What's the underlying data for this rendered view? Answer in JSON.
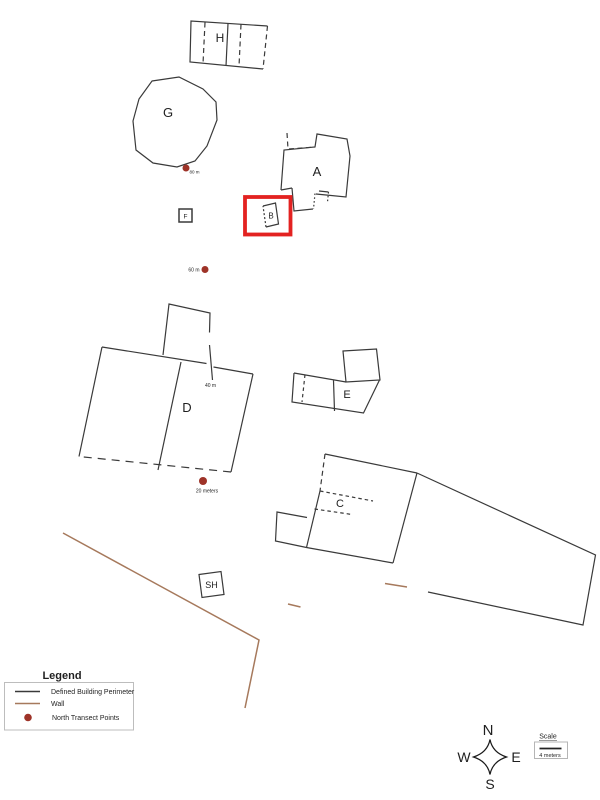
{
  "buildings": {
    "h": "H",
    "g": "G",
    "a": "A",
    "b": "B",
    "f": "F",
    "d": "D",
    "e": "E",
    "c": "C",
    "sh": "SH"
  },
  "transects": {
    "p80": "80 m",
    "p60": "60 m",
    "p40": "40 m",
    "p20": "20 meters"
  },
  "legend": {
    "title": "Legend",
    "items": [
      {
        "label": "Defined Building Perimeter",
        "swatch": "black-line",
        "color": "#3a3a3a"
      },
      {
        "label": "Wall",
        "swatch": "brown-line",
        "color": "#a6795c"
      },
      {
        "label": "North Transect Points",
        "swatch": "red-dot",
        "color": "#9e3328"
      }
    ]
  },
  "compass": {
    "n": "N",
    "e": "E",
    "s": "S",
    "w": "W"
  },
  "scale": {
    "title": "Scale",
    "label": "4 meters"
  },
  "colors": {
    "building_outline": "#3a3a3a",
    "wall": "#a6795c",
    "transect_point": "#9e3328",
    "highlight_box": "#e32221",
    "background": "#ffffff"
  }
}
